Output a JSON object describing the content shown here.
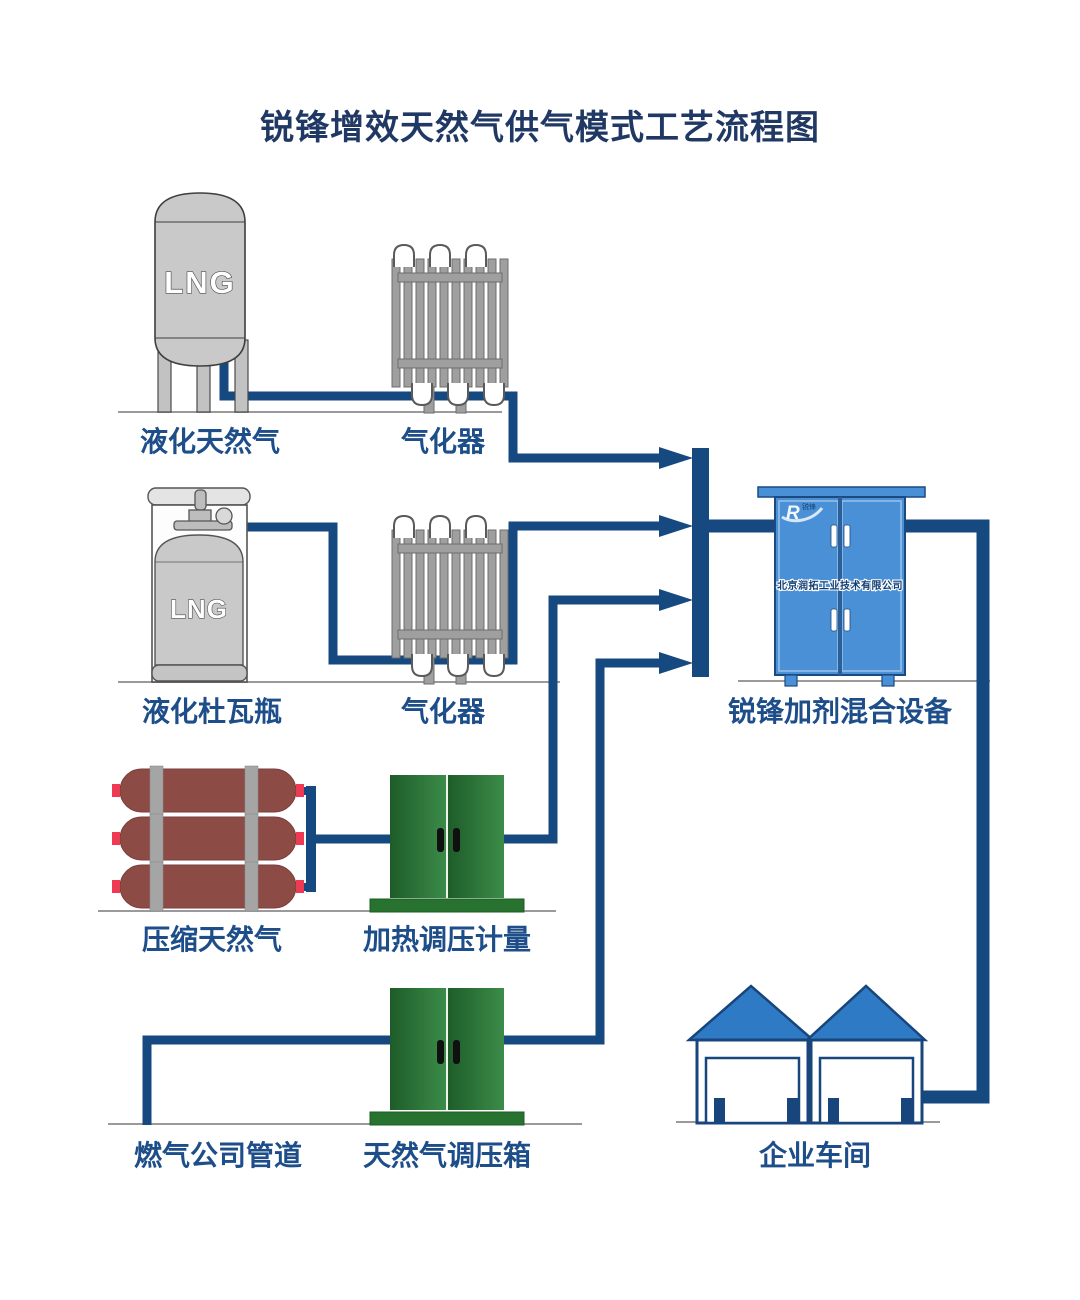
{
  "title": "锐锋增效天然气供气模式工艺流程图",
  "colors": {
    "pipe": "#15497F",
    "label_text": "#1D4E89",
    "title_text": "#203864",
    "tank_gray": "#C9C9C9",
    "cng_maroon": "#8D4B45",
    "cabinet_green": "#2E7D3A",
    "cabinet_blue": "#4A90D6",
    "roof_blue": "#2E7AC4"
  },
  "nodes": {
    "lng_tank": {
      "label": "液化天然气",
      "tank_text": "LNG"
    },
    "vaporizer1": {
      "label": "气化器"
    },
    "dewar": {
      "label": "液化杜瓦瓶",
      "tank_text": "LNG"
    },
    "vaporizer2": {
      "label": "气化器"
    },
    "cng": {
      "label": "压缩天然气"
    },
    "heater": {
      "label": "加热调压计量"
    },
    "pipeline": {
      "label": "燃气公司管道"
    },
    "regulator": {
      "label": "天然气调压箱"
    },
    "mixer": {
      "label": "锐锋加剂混合设备",
      "company": "北京润拓工业技术有限公司",
      "logo": "R",
      "logo_sub": "锐锋"
    },
    "workshop": {
      "label": "企业车间"
    }
  }
}
